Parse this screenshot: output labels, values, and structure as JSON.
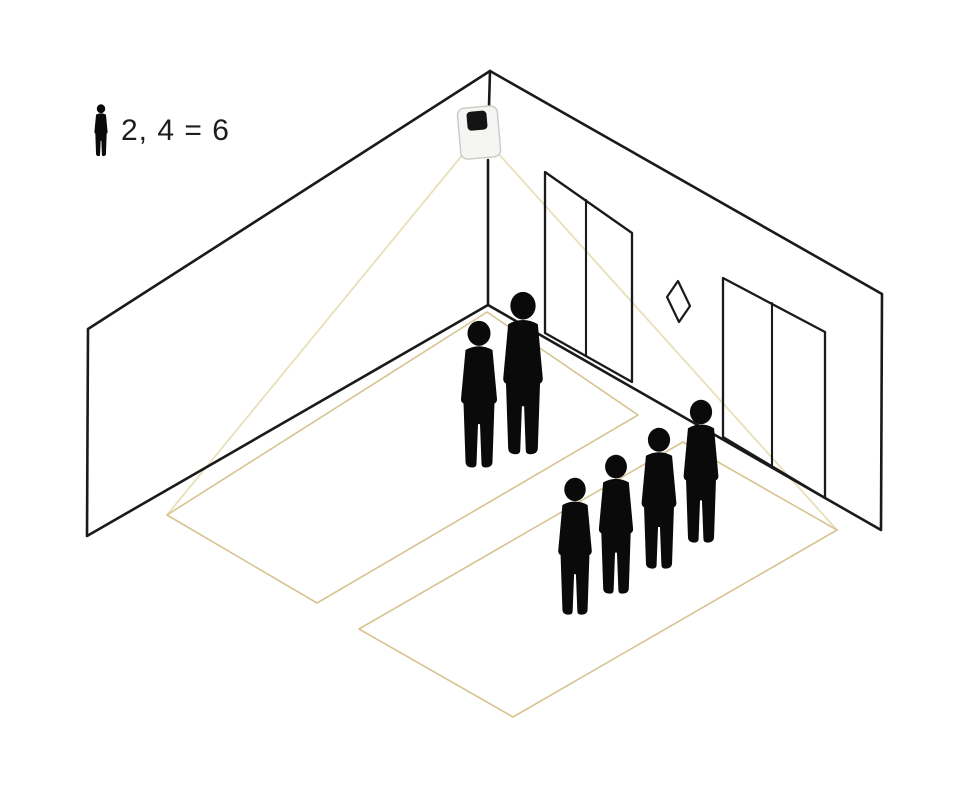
{
  "legend": {
    "text": "2, 4 = 6"
  },
  "counts": {
    "zone1_people": 2,
    "zone2_people": 4,
    "total": 6
  },
  "colors": {
    "background": "#ffffff",
    "line": "#1a1a1a",
    "zone_line": "#d6c491",
    "cone_line": "#e8e0ba",
    "person": "#0a0a0a",
    "sensor_body": "#f5f5f3",
    "sensor_border": "#c9c9c5",
    "sensor_window": "#141414",
    "legend_text": "#1d1d1d"
  },
  "geometry": {
    "room": {
      "corner_top": [
        490,
        71
      ],
      "corner_bottom": [
        488,
        305
      ],
      "corner_line_upper": [
        [
          490,
          71
        ],
        [
          489,
          106
        ]
      ],
      "corner_line_lower": [
        [
          488,
          160
        ],
        [
          488,
          305
        ]
      ],
      "left_wall": [
        [
          490,
          71
        ],
        [
          88,
          329
        ],
        [
          87,
          536
        ],
        [
          488,
          305
        ]
      ],
      "right_wall": [
        [
          490,
          71
        ],
        [
          882,
          294
        ],
        [
          881,
          530
        ],
        [
          488,
          305
        ]
      ]
    },
    "doors": [
      {
        "name": "elevator-door-1",
        "outline": [
          [
            545,
            172
          ],
          [
            632,
            233
          ],
          [
            632,
            382
          ],
          [
            545,
            333
          ]
        ],
        "divider": [
          [
            586,
            200
          ],
          [
            586,
            355
          ]
        ]
      },
      {
        "name": "elevator-door-2",
        "outline": [
          [
            723,
            278
          ],
          [
            825,
            332
          ],
          [
            825,
            498
          ],
          [
            723,
            437
          ]
        ],
        "divider": [
          [
            772,
            303
          ],
          [
            772,
            467
          ]
        ]
      }
    ],
    "call_panel": [
      [
        667,
        297
      ],
      [
        678,
        281
      ],
      [
        690,
        306
      ],
      [
        679,
        322
      ]
    ],
    "sensor": {
      "cx": 479,
      "cy": 132,
      "body": {
        "x": 459,
        "y": 107,
        "w": 40,
        "h": 51,
        "rx": 7
      },
      "window": {
        "x": 468,
        "y": 111,
        "w": 20,
        "h": 19,
        "rx": 4
      },
      "rotate": -5
    },
    "cone_lines": [
      {
        "name": "cone-line-left",
        "from": [
          464,
          153
        ],
        "to": [
          167,
          515
        ]
      },
      {
        "name": "cone-line-right",
        "from": [
          496,
          151
        ],
        "to": [
          837,
          530
        ]
      }
    ],
    "zones": [
      {
        "name": "detection-zone-1",
        "people": 2,
        "points": [
          [
            487,
            312
          ],
          [
            638,
            415
          ],
          [
            317,
            603
          ],
          [
            167,
            515
          ]
        ]
      },
      {
        "name": "detection-zone-2",
        "people": 4,
        "points": [
          [
            683,
            442
          ],
          [
            837,
            530
          ],
          [
            513,
            717
          ],
          [
            359,
            629
          ]
        ]
      }
    ],
    "people": [
      {
        "zone": 1,
        "cx": 523,
        "top": 291,
        "h": 166
      },
      {
        "zone": 1,
        "cx": 479,
        "top": 320,
        "h": 150
      },
      {
        "zone": 2,
        "cx": 701,
        "top": 399,
        "h": 146
      },
      {
        "zone": 2,
        "cx": 659,
        "top": 427,
        "h": 144
      },
      {
        "zone": 2,
        "cx": 616,
        "top": 454,
        "h": 142
      },
      {
        "zone": 2,
        "cx": 575,
        "top": 477,
        "h": 140
      }
    ]
  }
}
